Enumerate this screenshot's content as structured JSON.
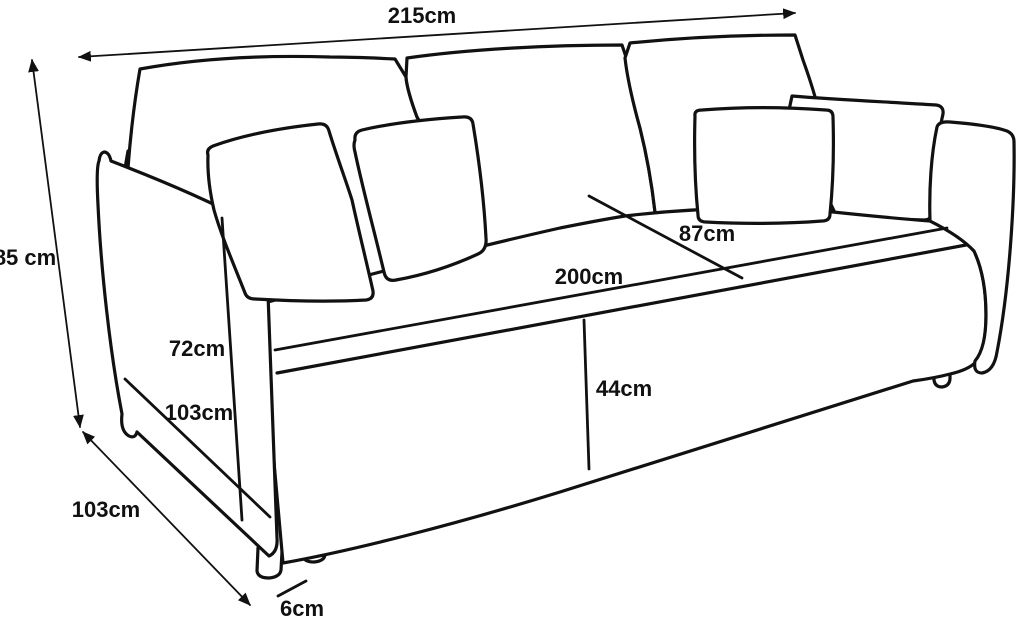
{
  "diagram": {
    "kind": "sofa dimension line drawing",
    "colors": {
      "background": "#ffffff",
      "line": "#111111"
    }
  },
  "labels": {
    "overall_width": "215cm",
    "overall_height": "85 cm",
    "seat_depth": "87cm",
    "seat_width": "200cm",
    "armrest_height": "72cm",
    "armrest_diagonal": "103cm",
    "overall_depth": "103cm",
    "seat_height": "44cm",
    "leg_height": "6cm"
  }
}
